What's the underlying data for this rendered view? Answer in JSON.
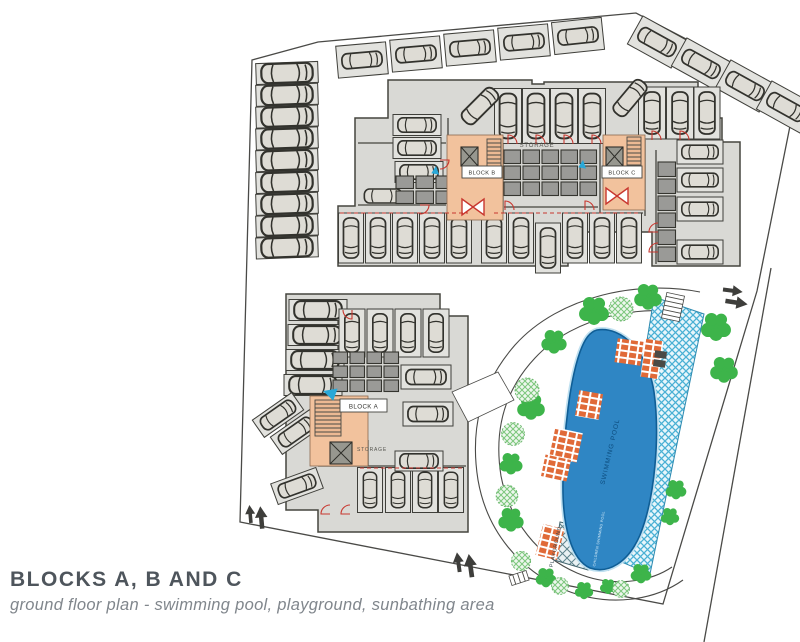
{
  "header": {
    "title": "BLOCKS A, B AND C",
    "subtitle": "ground floor plan - swimming pool, playground, sunbathing area"
  },
  "labels": {
    "block_a": "BLOCK A",
    "block_b": "BLOCK B",
    "block_c": "BLOCK C",
    "storage_bc": "STORAGE",
    "storage_a": "STORAGE",
    "swimming_pool": "SWIMMING POOL",
    "children_pool": "CHILDREN SWIMMING POOL",
    "playground": "PLAYGROUND"
  },
  "colors": {
    "boundary": "#4a4a47",
    "building": "#d9d9d5",
    "building_line": "#45453f",
    "stall": "#e2e2de",
    "car": "#dedcd5",
    "cell": "#9a9a97",
    "core": "#f2c29d",
    "red": "#c8372f",
    "pool": "#2f86c4",
    "pool_rim": "#0f5e96",
    "deck_line": "#49b0d4",
    "tree": "#3db44a",
    "shrub": "#7cc77c",
    "sunbed": "#e06a38",
    "arrow": "#3e3e3b",
    "marker": "#29a8d8",
    "title": "#4e555c",
    "subtitle": "#80868c"
  }
}
